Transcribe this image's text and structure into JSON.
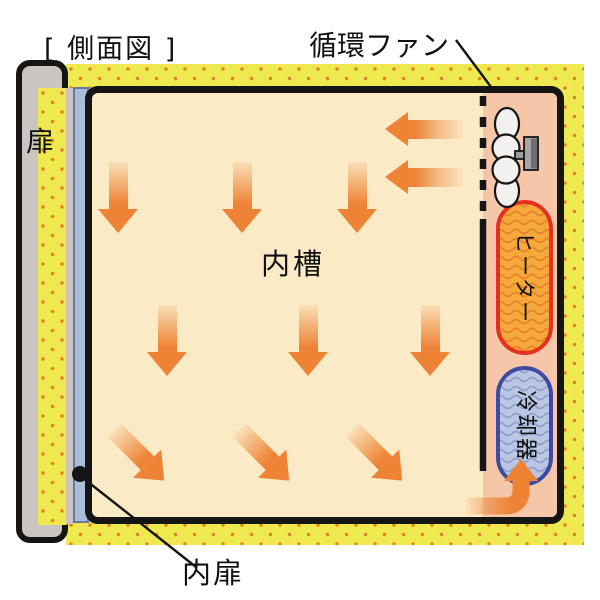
{
  "title": "[ 側面図 ]",
  "labels": {
    "door": "扉",
    "circulation_fan": "循環ファン",
    "inner_tank": "内槽",
    "heater": "ヒーター",
    "cooler": "冷却器",
    "inner_door": "内扉"
  },
  "colors": {
    "insulation_yellow": "#EDE94F",
    "insulation_dot_orange": "#E0832C",
    "chamber_cream": "#FAEAC6",
    "fan_plenum_salmon": "#F5C6A8",
    "door_gray": "#CBC5C1",
    "inner_door_blue": "#A9BCD9",
    "heater_fill": "#F6A93B",
    "heater_border_red": "#E6301F",
    "heater_wave": "#E5832B",
    "cooler_fill": "#BAC6E3",
    "cooler_border_blue": "#3D4BA0",
    "cooler_wave": "#90A2CB",
    "airflow_arrow_orange": "#EE8335",
    "outline_black": "#151515"
  }
}
